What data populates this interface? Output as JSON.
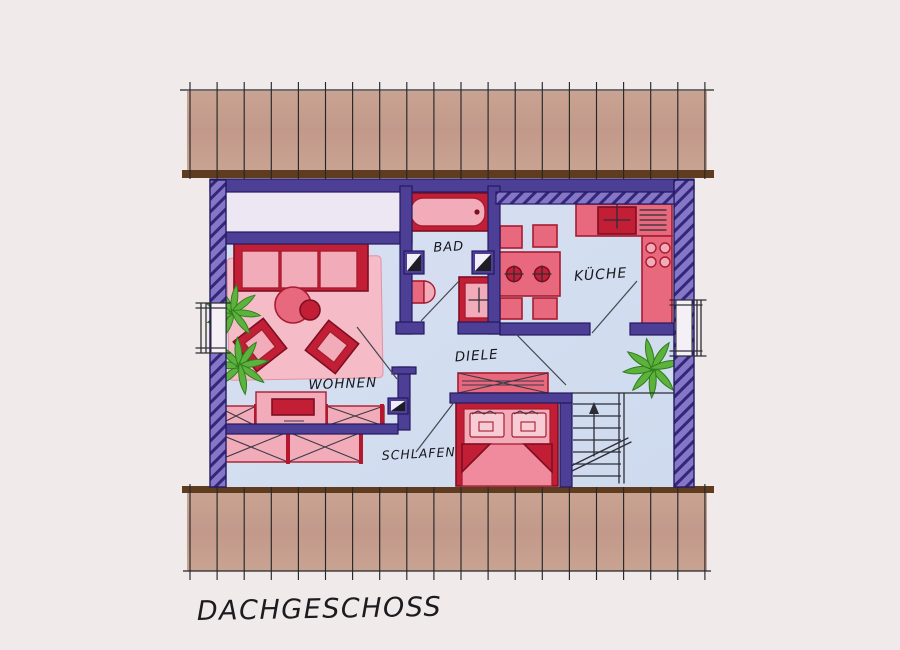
{
  "drawing": {
    "title": "DACHGESCHOSS",
    "rooms": {
      "wohnen": {
        "label": "WOHNEN"
      },
      "bad": {
        "label": "BAD"
      },
      "kueche": {
        "label": "KÜCHE"
      },
      "diele": {
        "label": "DIELE"
      },
      "schlafen": {
        "label": "SCHLAFEN"
      }
    },
    "icons": {
      "plant": "palm-plant-icon",
      "stairs_direction": "up-arrow-icon",
      "vent_shaft": "duct-shaft-icon"
    },
    "colors": {
      "paper": "#f1eaea",
      "floor_blue": "#cedaee",
      "wall_interior_purple": "#4d3f96",
      "wall_exterior_purple": "#8577c6",
      "roof_band_tan": "#c9a392",
      "roof_edge_brown": "#5f3c20",
      "furniture_red": "#c21f36",
      "furniture_pink": "#f2acb9",
      "rug_pink": "#f5bcc8",
      "plant_green": "#5cb23c",
      "ink": "#2d2d36"
    }
  }
}
